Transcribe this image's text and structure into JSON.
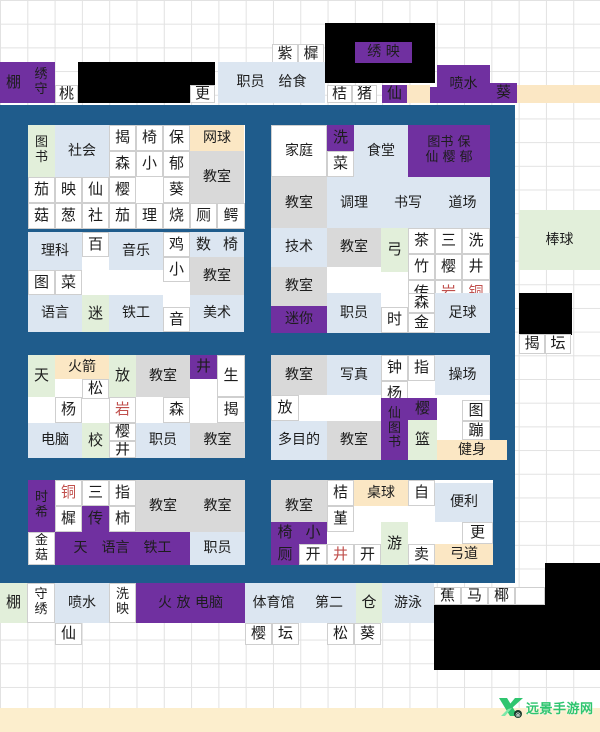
{
  "watermark": {
    "text": "远景手游网",
    "color": "#2fc56f"
  },
  "colors": {
    "white": "#ffffff",
    "purple": "#7030a0",
    "bluepanel": "#1f5c8c",
    "lblue": "#dce6f1",
    "gray": "#d9d9d9",
    "green": "#e2efda",
    "cream": "#fbe7c4",
    "band": "#fceecd",
    "black": "#000000",
    "text": "#1d1d1d",
    "red": "#c0504d"
  },
  "black_boxes": [
    {
      "x": 325,
      "y": 23,
      "w": 110,
      "h": 60
    },
    {
      "x": 78,
      "y": 62,
      "w": 137,
      "h": 41
    },
    {
      "x": 519,
      "y": 293,
      "w": 53,
      "h": 42
    },
    {
      "x": 545,
      "y": 563,
      "w": 55,
      "h": 42
    },
    {
      "x": 434,
      "y": 605,
      "w": 166,
      "h": 65
    }
  ],
  "panels": [
    {
      "x": 28,
      "y": 125,
      "w": 217,
      "h": 104
    },
    {
      "x": 271,
      "y": 125,
      "w": 219,
      "h": 104
    },
    {
      "x": 28,
      "y": 232,
      "w": 216,
      "h": 100
    },
    {
      "x": 271,
      "y": 228,
      "w": 219,
      "h": 105
    },
    {
      "x": 28,
      "y": 355,
      "w": 217,
      "h": 103
    },
    {
      "x": 271,
      "y": 355,
      "w": 219,
      "h": 105
    },
    {
      "x": 28,
      "y": 480,
      "w": 217,
      "h": 85
    },
    {
      "x": 271,
      "y": 480,
      "w": 222,
      "h": 85
    }
  ],
  "cells": [
    {
      "t": "紫",
      "x": 272,
      "y": 44,
      "w": 26,
      "h": 20
    },
    {
      "t": "樨",
      "x": 298,
      "y": 44,
      "w": 26,
      "h": 20
    },
    {
      "t": "绣 映",
      "x": 355,
      "y": 42,
      "w": 57,
      "h": 21,
      "bg": "purple"
    },
    {
      "t": "棚",
      "x": 0,
      "y": 62,
      "w": 27,
      "h": 41,
      "bg": "purple"
    },
    {
      "t": "绣\n守",
      "x": 27,
      "y": 62,
      "w": 28,
      "h": 41,
      "bg": "purple"
    },
    {
      "t": "桃",
      "x": 55,
      "y": 85,
      "w": 23,
      "h": 18
    },
    {
      "t": "更",
      "x": 190,
      "y": 85,
      "w": 25,
      "h": 18
    },
    {
      "t": "职员　给食",
      "x": 218,
      "y": 62,
      "w": 107,
      "h": 41,
      "bg": "lblue"
    },
    {
      "t": "桔",
      "x": 327,
      "y": 85,
      "w": 25,
      "h": 18
    },
    {
      "t": "猪",
      "x": 352,
      "y": 85,
      "w": 25,
      "h": 18
    },
    {
      "t": "仙",
      "x": 382,
      "y": 85,
      "w": 25,
      "h": 18,
      "bg": "purple"
    },
    {
      "t": "",
      "x": 407,
      "y": 85,
      "w": 23,
      "h": 18,
      "bg": "cream"
    },
    {
      "t": "",
      "x": 430,
      "y": 87,
      "w": 8,
      "h": 16,
      "bg": "purple"
    },
    {
      "t": "喷水",
      "x": 437,
      "y": 65,
      "w": 53,
      "h": 38,
      "bg": "purple"
    },
    {
      "t": "葵",
      "x": 490,
      "y": 83,
      "w": 27,
      "h": 20,
      "bg": "purple"
    },
    {
      "t": "",
      "x": 517,
      "y": 85,
      "w": 83,
      "h": 18,
      "bg": "cream"
    },
    {
      "t": "棒球",
      "x": 519,
      "y": 210,
      "w": 81,
      "h": 60,
      "bg": "green"
    },
    {
      "t": "揭",
      "x": 519,
      "y": 334,
      "w": 26,
      "h": 20
    },
    {
      "t": "坛",
      "x": 545,
      "y": 334,
      "w": 26,
      "h": 20
    },
    {
      "t": "图\n书",
      "x": 28,
      "y": 125,
      "w": 27,
      "h": 52,
      "bg": "green"
    },
    {
      "t": "社会",
      "x": 55,
      "y": 125,
      "w": 54,
      "h": 52,
      "bg": "lblue"
    },
    {
      "t": "揭",
      "x": 109,
      "y": 125,
      "w": 27,
      "h": 26
    },
    {
      "t": "椅",
      "x": 136,
      "y": 125,
      "w": 27,
      "h": 26
    },
    {
      "t": "保",
      "x": 163,
      "y": 125,
      "w": 27,
      "h": 26
    },
    {
      "t": "网球",
      "x": 190,
      "y": 125,
      "w": 54,
      "h": 26,
      "bg": "cream"
    },
    {
      "t": "森",
      "x": 109,
      "y": 151,
      "w": 27,
      "h": 26
    },
    {
      "t": "小",
      "x": 136,
      "y": 151,
      "w": 27,
      "h": 26
    },
    {
      "t": "郁",
      "x": 163,
      "y": 151,
      "w": 27,
      "h": 26
    },
    {
      "t": "教室",
      "x": 190,
      "y": 151,
      "w": 54,
      "h": 52,
      "bg": "gray"
    },
    {
      "t": "茄",
      "x": 28,
      "y": 177,
      "w": 27,
      "h": 26
    },
    {
      "t": "映",
      "x": 55,
      "y": 177,
      "w": 27,
      "h": 26
    },
    {
      "t": "仙",
      "x": 82,
      "y": 177,
      "w": 27,
      "h": 26
    },
    {
      "t": "樱",
      "x": 109,
      "y": 177,
      "w": 27,
      "h": 26
    },
    {
      "t": "葵",
      "x": 163,
      "y": 177,
      "w": 27,
      "h": 26
    },
    {
      "t": "菇",
      "x": 28,
      "y": 203,
      "w": 27,
      "h": 26
    },
    {
      "t": "葱",
      "x": 55,
      "y": 203,
      "w": 27,
      "h": 26
    },
    {
      "t": "社",
      "x": 82,
      "y": 203,
      "w": 27,
      "h": 26
    },
    {
      "t": "茄",
      "x": 109,
      "y": 203,
      "w": 27,
      "h": 26
    },
    {
      "t": "理",
      "x": 136,
      "y": 203,
      "w": 27,
      "h": 26
    },
    {
      "t": "烧",
      "x": 163,
      "y": 203,
      "w": 27,
      "h": 26
    },
    {
      "t": "厕",
      "x": 190,
      "y": 203,
      "w": 27,
      "h": 26
    },
    {
      "t": "鳄",
      "x": 217,
      "y": 203,
      "w": 28,
      "h": 26
    },
    {
      "t": "家庭",
      "x": 271,
      "y": 125,
      "w": 56,
      "h": 52
    },
    {
      "t": "洗",
      "x": 327,
      "y": 125,
      "w": 27,
      "h": 26,
      "bg": "purple"
    },
    {
      "t": "菜",
      "x": 327,
      "y": 151,
      "w": 27,
      "h": 26
    },
    {
      "t": "食堂",
      "x": 354,
      "y": 125,
      "w": 54,
      "h": 52,
      "bg": "lblue"
    },
    {
      "t": "图书 保\n仙 樱 郁",
      "x": 408,
      "y": 125,
      "w": 82,
      "h": 52,
      "bg": "purple"
    },
    {
      "t": "教室",
      "x": 271,
      "y": 177,
      "w": 56,
      "h": 52,
      "bg": "gray"
    },
    {
      "t": "调理",
      "x": 327,
      "y": 177,
      "w": 54,
      "h": 52,
      "bg": "lblue"
    },
    {
      "t": "书写",
      "x": 381,
      "y": 177,
      "w": 54,
      "h": 52,
      "bg": "lblue"
    },
    {
      "t": "道场",
      "x": 435,
      "y": 177,
      "w": 55,
      "h": 52,
      "bg": "lblue"
    },
    {
      "t": "理科",
      "x": 28,
      "y": 232,
      "w": 54,
      "h": 38,
      "bg": "lblue"
    },
    {
      "t": "百",
      "x": 82,
      "y": 232,
      "w": 27,
      "h": 25
    },
    {
      "t": "音乐",
      "x": 109,
      "y": 232,
      "w": 54,
      "h": 38,
      "bg": "lblue"
    },
    {
      "t": "鸡",
      "x": 163,
      "y": 232,
      "w": 27,
      "h": 25
    },
    {
      "t": "小",
      "x": 163,
      "y": 257,
      "w": 27,
      "h": 25
    },
    {
      "t": "数",
      "x": 190,
      "y": 232,
      "w": 27,
      "h": 25,
      "bg": "lblue"
    },
    {
      "t": "椅",
      "x": 217,
      "y": 232,
      "w": 27,
      "h": 25,
      "bg": "lblue"
    },
    {
      "t": "教室",
      "x": 190,
      "y": 257,
      "w": 54,
      "h": 38,
      "bg": "gray"
    },
    {
      "t": "图",
      "x": 28,
      "y": 270,
      "w": 27,
      "h": 25
    },
    {
      "t": "菜",
      "x": 55,
      "y": 270,
      "w": 27,
      "h": 25
    },
    {
      "t": "语言",
      "x": 28,
      "y": 295,
      "w": 54,
      "h": 37,
      "bg": "lblue"
    },
    {
      "t": "迷",
      "x": 82,
      "y": 295,
      "w": 27,
      "h": 37,
      "bg": "green"
    },
    {
      "t": "铁工",
      "x": 109,
      "y": 295,
      "w": 54,
      "h": 37,
      "bg": "lblue"
    },
    {
      "t": "音",
      "x": 163,
      "y": 307,
      "w": 27,
      "h": 25
    },
    {
      "t": "美术",
      "x": 190,
      "y": 295,
      "w": 54,
      "h": 37,
      "bg": "lblue"
    },
    {
      "t": "技术",
      "x": 271,
      "y": 228,
      "w": 56,
      "h": 39,
      "bg": "lblue"
    },
    {
      "t": "教室",
      "x": 327,
      "y": 228,
      "w": 54,
      "h": 39,
      "bg": "gray"
    },
    {
      "t": "弓",
      "x": 381,
      "y": 228,
      "w": 27,
      "h": 44,
      "bg": "green"
    },
    {
      "t": "茶",
      "x": 408,
      "y": 228,
      "w": 27,
      "h": 26
    },
    {
      "t": "竹",
      "x": 408,
      "y": 254,
      "w": 27,
      "h": 26
    },
    {
      "t": "三",
      "x": 435,
      "y": 228,
      "w": 27,
      "h": 26
    },
    {
      "t": "樱",
      "x": 435,
      "y": 254,
      "w": 27,
      "h": 26
    },
    {
      "t": "洗",
      "x": 462,
      "y": 228,
      "w": 28,
      "h": 26
    },
    {
      "t": "井",
      "x": 462,
      "y": 254,
      "w": 28,
      "h": 26
    },
    {
      "t": "教室",
      "x": 271,
      "y": 267,
      "w": 56,
      "h": 39,
      "bg": "gray"
    },
    {
      "t": "传",
      "x": 408,
      "y": 280,
      "w": 27,
      "h": 26
    },
    {
      "t": "岩",
      "x": 435,
      "y": 280,
      "w": 27,
      "h": 26,
      "fg": "red"
    },
    {
      "t": "铜",
      "x": 462,
      "y": 280,
      "w": 28,
      "h": 26,
      "fg": "red"
    },
    {
      "t": "迷你",
      "x": 271,
      "y": 306,
      "w": 56,
      "h": 27,
      "bg": "purple"
    },
    {
      "t": "职员",
      "x": 327,
      "y": 293,
      "w": 54,
      "h": 40,
      "bg": "lblue"
    },
    {
      "t": "时",
      "x": 381,
      "y": 307,
      "w": 27,
      "h": 26
    },
    {
      "t": "森",
      "x": 408,
      "y": 293,
      "w": 27,
      "h": 20
    },
    {
      "t": "金",
      "x": 408,
      "y": 313,
      "w": 27,
      "h": 20
    },
    {
      "t": "足球",
      "x": 435,
      "y": 293,
      "w": 55,
      "h": 40,
      "bg": "lblue"
    },
    {
      "t": "天",
      "x": 28,
      "y": 355,
      "w": 27,
      "h": 42,
      "bg": "green"
    },
    {
      "t": "火箭",
      "x": 55,
      "y": 355,
      "w": 54,
      "h": 24,
      "bg": "cream"
    },
    {
      "t": "松",
      "x": 82,
      "y": 379,
      "w": 27,
      "h": 20
    },
    {
      "t": "放",
      "x": 109,
      "y": 355,
      "w": 27,
      "h": 42,
      "bg": "green"
    },
    {
      "t": "教室",
      "x": 136,
      "y": 355,
      "w": 54,
      "h": 42,
      "bg": "gray"
    },
    {
      "t": "井",
      "x": 190,
      "y": 355,
      "w": 27,
      "h": 24,
      "bg": "purple"
    },
    {
      "t": "生",
      "x": 217,
      "y": 355,
      "w": 28,
      "h": 42
    },
    {
      "t": "杨",
      "x": 55,
      "y": 397,
      "w": 27,
      "h": 26
    },
    {
      "t": "岩",
      "x": 109,
      "y": 397,
      "w": 27,
      "h": 26,
      "fg": "red"
    },
    {
      "t": "森",
      "x": 163,
      "y": 397,
      "w": 27,
      "h": 26
    },
    {
      "t": "揭",
      "x": 217,
      "y": 397,
      "w": 28,
      "h": 26
    },
    {
      "t": "电脑",
      "x": 28,
      "y": 423,
      "w": 54,
      "h": 35,
      "bg": "lblue"
    },
    {
      "t": "校",
      "x": 82,
      "y": 423,
      "w": 27,
      "h": 35,
      "bg": "green"
    },
    {
      "t": "樱",
      "x": 109,
      "y": 423,
      "w": 27,
      "h": 18
    },
    {
      "t": "井",
      "x": 109,
      "y": 441,
      "w": 27,
      "h": 17
    },
    {
      "t": "职员",
      "x": 136,
      "y": 423,
      "w": 54,
      "h": 35,
      "bg": "lblue"
    },
    {
      "t": "教室",
      "x": 190,
      "y": 423,
      "w": 55,
      "h": 35,
      "bg": "gray"
    },
    {
      "t": "教室",
      "x": 271,
      "y": 355,
      "w": 56,
      "h": 40,
      "bg": "gray"
    },
    {
      "t": "写真",
      "x": 327,
      "y": 355,
      "w": 54,
      "h": 40,
      "bg": "lblue"
    },
    {
      "t": "钟",
      "x": 381,
      "y": 355,
      "w": 27,
      "h": 26
    },
    {
      "t": "杨",
      "x": 381,
      "y": 381,
      "w": 27,
      "h": 26
    },
    {
      "t": "指",
      "x": 408,
      "y": 355,
      "w": 27,
      "h": 26
    },
    {
      "t": "操场",
      "x": 435,
      "y": 355,
      "w": 55,
      "h": 40,
      "bg": "lblue"
    },
    {
      "t": "放",
      "x": 271,
      "y": 395,
      "w": 28,
      "h": 26
    },
    {
      "t": "仙\n图\n书",
      "x": 381,
      "y": 398,
      "w": 27,
      "h": 62,
      "bg": "purple"
    },
    {
      "t": "樱",
      "x": 408,
      "y": 398,
      "w": 29,
      "h": 22,
      "bg": "purple"
    },
    {
      "t": "篮",
      "x": 408,
      "y": 420,
      "w": 29,
      "h": 40,
      "bg": "green"
    },
    {
      "t": "图",
      "x": 462,
      "y": 400,
      "w": 28,
      "h": 21
    },
    {
      "t": "蹦",
      "x": 462,
      "y": 421,
      "w": 28,
      "h": 19
    },
    {
      "t": "多目的",
      "x": 271,
      "y": 421,
      "w": 56,
      "h": 39,
      "bg": "lblue"
    },
    {
      "t": "教室",
      "x": 327,
      "y": 421,
      "w": 54,
      "h": 39,
      "bg": "gray"
    },
    {
      "t": "健身",
      "x": 437,
      "y": 440,
      "w": 70,
      "h": 20,
      "bg": "cream"
    },
    {
      "t": "时\n希",
      "x": 28,
      "y": 480,
      "w": 27,
      "h": 52,
      "bg": "purple"
    },
    {
      "t": "铜",
      "x": 55,
      "y": 480,
      "w": 27,
      "h": 26,
      "fg": "red"
    },
    {
      "t": "樨",
      "x": 55,
      "y": 506,
      "w": 27,
      "h": 26
    },
    {
      "t": "三",
      "x": 82,
      "y": 480,
      "w": 27,
      "h": 26
    },
    {
      "t": "传",
      "x": 82,
      "y": 506,
      "w": 27,
      "h": 26,
      "bg": "purple"
    },
    {
      "t": "指",
      "x": 109,
      "y": 480,
      "w": 27,
      "h": 26
    },
    {
      "t": "柿",
      "x": 109,
      "y": 506,
      "w": 27,
      "h": 26
    },
    {
      "t": "教室",
      "x": 136,
      "y": 480,
      "w": 54,
      "h": 52,
      "bg": "gray"
    },
    {
      "t": "教室",
      "x": 190,
      "y": 480,
      "w": 55,
      "h": 52,
      "bg": "gray"
    },
    {
      "t": "金\n菇",
      "x": 28,
      "y": 532,
      "w": 27,
      "h": 33
    },
    {
      "t": "天　语言　铁工",
      "x": 55,
      "y": 532,
      "w": 135,
      "h": 33,
      "bg": "purple"
    },
    {
      "t": "职员",
      "x": 190,
      "y": 532,
      "w": 55,
      "h": 33,
      "bg": "lblue"
    },
    {
      "t": "教室",
      "x": 271,
      "y": 480,
      "w": 56,
      "h": 52,
      "bg": "gray"
    },
    {
      "t": "桔",
      "x": 327,
      "y": 480,
      "w": 27,
      "h": 26
    },
    {
      "t": "堇",
      "x": 327,
      "y": 506,
      "w": 27,
      "h": 26
    },
    {
      "t": "桌球",
      "x": 354,
      "y": 480,
      "w": 54,
      "h": 26,
      "bg": "cream"
    },
    {
      "t": "自",
      "x": 408,
      "y": 480,
      "w": 27,
      "h": 26
    },
    {
      "t": "便利",
      "x": 435,
      "y": 483,
      "w": 58,
      "h": 39,
      "bg": "lblue"
    },
    {
      "t": "椅",
      "x": 271,
      "y": 522,
      "w": 28,
      "h": 22,
      "bg": "purple"
    },
    {
      "t": "小",
      "x": 299,
      "y": 522,
      "w": 28,
      "h": 22,
      "bg": "purple"
    },
    {
      "t": "厕",
      "x": 271,
      "y": 544,
      "w": 28,
      "h": 21,
      "bg": "purple"
    },
    {
      "t": "开",
      "x": 299,
      "y": 544,
      "w": 28,
      "h": 21
    },
    {
      "t": "井",
      "x": 327,
      "y": 544,
      "w": 27,
      "h": 21,
      "fg": "red"
    },
    {
      "t": "开",
      "x": 354,
      "y": 544,
      "w": 27,
      "h": 21
    },
    {
      "t": "游",
      "x": 381,
      "y": 522,
      "w": 27,
      "h": 43,
      "bg": "green"
    },
    {
      "t": "卖",
      "x": 408,
      "y": 544,
      "w": 27,
      "h": 21
    },
    {
      "t": "更",
      "x": 462,
      "y": 522,
      "w": 31,
      "h": 22
    },
    {
      "t": "弓道",
      "x": 435,
      "y": 544,
      "w": 58,
      "h": 21,
      "bg": "cream"
    },
    {
      "t": "棚",
      "x": 0,
      "y": 583,
      "w": 27,
      "h": 40,
      "bg": "green"
    },
    {
      "t": "守\n绣",
      "x": 27,
      "y": 583,
      "w": 28,
      "h": 40
    },
    {
      "t": "喷水",
      "x": 55,
      "y": 583,
      "w": 54,
      "h": 40,
      "bg": "lblue"
    },
    {
      "t": "洗\n映",
      "x": 109,
      "y": 583,
      "w": 27,
      "h": 40
    },
    {
      "t": "火 放 电脑",
      "x": 136,
      "y": 583,
      "w": 109,
      "h": 40,
      "bg": "purple"
    },
    {
      "t": "体育馆",
      "x": 245,
      "y": 583,
      "w": 57,
      "h": 40,
      "bg": "lblue"
    },
    {
      "t": "第二",
      "x": 302,
      "y": 583,
      "w": 54,
      "h": 40,
      "bg": "lblue"
    },
    {
      "t": "仓",
      "x": 356,
      "y": 583,
      "w": 26,
      "h": 40,
      "bg": "green"
    },
    {
      "t": "游泳",
      "x": 382,
      "y": 583,
      "w": 52,
      "h": 40,
      "bg": "lblue"
    },
    {
      "t": "蕉",
      "x": 434,
      "y": 587,
      "w": 27,
      "h": 18
    },
    {
      "t": "马",
      "x": 461,
      "y": 587,
      "w": 27,
      "h": 18
    },
    {
      "t": "椰",
      "x": 488,
      "y": 587,
      "w": 27,
      "h": 18
    },
    {
      "t": "",
      "x": 515,
      "y": 587,
      "w": 30,
      "h": 18
    },
    {
      "t": "仙",
      "x": 55,
      "y": 623,
      "w": 27,
      "h": 22
    },
    {
      "t": "樱",
      "x": 245,
      "y": 623,
      "w": 27,
      "h": 22
    },
    {
      "t": "坛",
      "x": 272,
      "y": 623,
      "w": 27,
      "h": 22
    },
    {
      "t": "松",
      "x": 327,
      "y": 623,
      "w": 27,
      "h": 22
    },
    {
      "t": "葵",
      "x": 354,
      "y": 623,
      "w": 27,
      "h": 22
    }
  ]
}
